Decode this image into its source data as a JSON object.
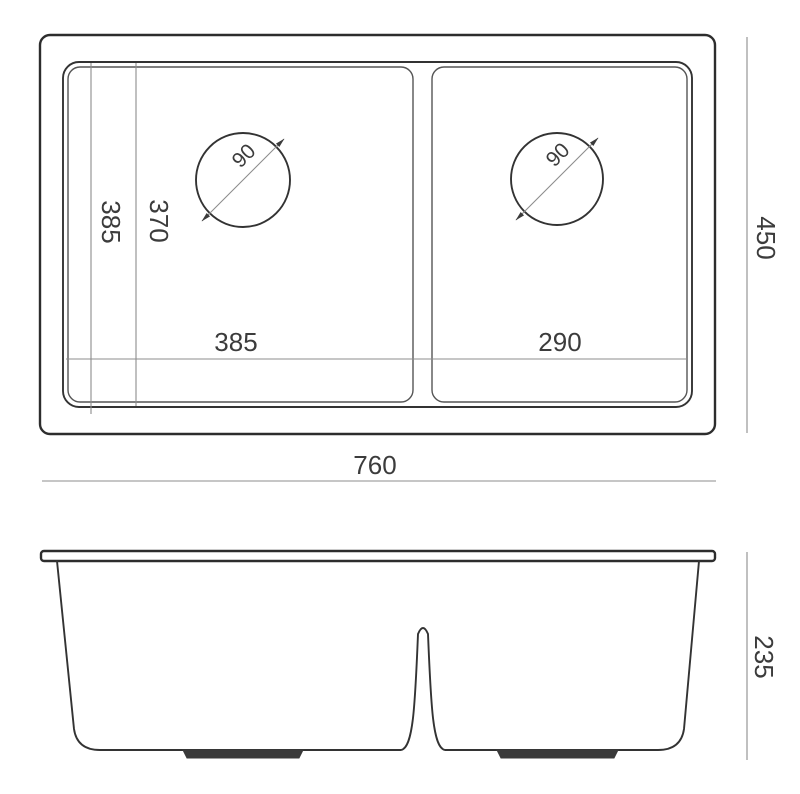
{
  "drawing": {
    "description": "Double bowl undermount sink technical dimension drawing, plan view and side profile view",
    "colors": {
      "ink": "#2d2d2d",
      "dimension_line": "#8c8c8c",
      "label_text": "#3c3c3c",
      "background": "#ffffff"
    },
    "top_view": {
      "overall_width": "760",
      "overall_depth": "450",
      "left_bowl_width": "385",
      "right_bowl_width": "290",
      "bowl_front_to_back": "385",
      "bowl_inner_front_to_back": "370",
      "left_drain_diameter": "90",
      "right_drain_diameter": "90"
    },
    "side_view": {
      "overall_height": "235"
    }
  }
}
